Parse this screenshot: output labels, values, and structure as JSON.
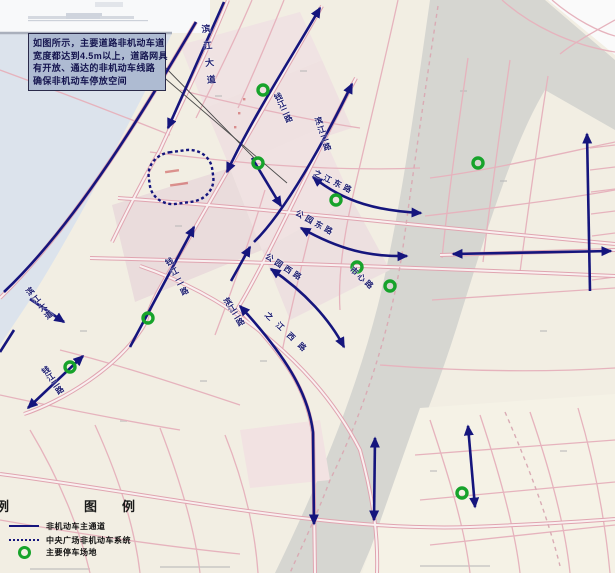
{
  "annotation_box": {
    "l1": "如图所示，主要道路非机动车道",
    "l2": "宽度都达到4.5m以上，道路网具",
    "l3": "有开放、通达的非机动车线路",
    "l4": "确保非机动车停放空间"
  },
  "legend": {
    "partial_title": "例",
    "title": "图　例",
    "items": [
      {
        "symbol": "solid-line",
        "label": "非机动车主通道"
      },
      {
        "symbol": "dashed-line",
        "label": "中央广场非机动车系统"
      },
      {
        "symbol": "green-circle",
        "label": "主要停车场地"
      }
    ]
  },
  "map": {
    "road_labels": [
      {
        "text": "滨江大道",
        "x": 199,
        "y": 24,
        "rot": -6,
        "fs": 9,
        "ls": 8,
        "mode": "v"
      },
      {
        "text": "钱江二路",
        "x": 271,
        "y": 93,
        "rot": -25,
        "fs": 8,
        "ls": 0,
        "mode": "v"
      },
      {
        "text": "滨江二路",
        "x": 312,
        "y": 117,
        "rot": -18,
        "fs": 8,
        "ls": 1,
        "mode": "v"
      },
      {
        "text": "之江东路",
        "x": 314,
        "y": 167,
        "rot": 26,
        "fs": 8,
        "ls": 3,
        "mode": "h"
      },
      {
        "text": "公园东路",
        "x": 296,
        "y": 207,
        "rot": 29,
        "fs": 8,
        "ls": 3,
        "mode": "h"
      },
      {
        "text": "公园西路",
        "x": 266,
        "y": 250,
        "rot": 33,
        "fs": 8,
        "ls": 3,
        "mode": "h"
      },
      {
        "text": "市心路",
        "x": 351,
        "y": 263,
        "rot": 42,
        "fs": 8,
        "ls": 2,
        "mode": "h"
      },
      {
        "text": "之江西路",
        "x": 266,
        "y": 308,
        "rot": 43,
        "fs": 8,
        "ls": 7,
        "mode": "h"
      },
      {
        "text": "钱江二路",
        "x": 162,
        "y": 258,
        "rot": -27,
        "fs": 8,
        "ls": 3,
        "mode": "v"
      },
      {
        "text": "滨江二路",
        "x": 220,
        "y": 298,
        "rot": -32,
        "fs": 8,
        "ls": 0,
        "mode": "v"
      },
      {
        "text": "钱江二路",
        "x": 38,
        "y": 367,
        "rot": -35,
        "fs": 8,
        "ls": 0,
        "mode": "v"
      },
      {
        "text": "滨江大道",
        "x": 22,
        "y": 288,
        "rot": -38,
        "fs": 8,
        "ls": 2,
        "mode": "v"
      }
    ],
    "parking_markers": [
      [
        263,
        90
      ],
      [
        478,
        163
      ],
      [
        258,
        163
      ],
      [
        336,
        200
      ],
      [
        357,
        267
      ],
      [
        390,
        286
      ],
      [
        148,
        318
      ],
      [
        70,
        367
      ],
      [
        462,
        493
      ]
    ],
    "routes": [
      {
        "d": "M224,2 L168,128",
        "s": false,
        "e": true
      },
      {
        "d": "M196,22 C150,100 80,220 4,292",
        "s": false,
        "e": false
      },
      {
        "d": "M30,299 L64,322",
        "s": false,
        "e": true
      },
      {
        "d": "M14,330 L0,352",
        "s": false,
        "e": false
      },
      {
        "d": "M320,8 C290,60 252,118 227,172",
        "s": true,
        "e": true
      },
      {
        "d": "M252,158 L281,206",
        "s": false,
        "e": true
      },
      {
        "d": "M313,177 C345,203 380,211 421,213",
        "s": true,
        "e": true
      },
      {
        "d": "M301,228 C340,250 370,257 407,256",
        "s": true,
        "e": true
      },
      {
        "d": "M231,281 L250,247",
        "s": false,
        "e": true
      },
      {
        "d": "M271,269 C305,292 330,320 344,347",
        "s": true,
        "e": true
      },
      {
        "d": "M352,84 C325,140 285,212 254,242",
        "s": true,
        "e": false
      },
      {
        "d": "M240,306 C285,355 308,392 313,432 L314,524",
        "s": true,
        "e": true
      },
      {
        "d": "M130,347 L194,227",
        "s": false,
        "e": true
      },
      {
        "d": "M28,408 L83,356",
        "s": true,
        "e": true
      },
      {
        "d": "M590,291 L587,134",
        "s": false,
        "e": true
      },
      {
        "d": "M453,254 L611,251",
        "s": true,
        "e": true
      },
      {
        "d": "M468,426 L475,507",
        "s": true,
        "e": true
      },
      {
        "d": "M375,438 L374,520",
        "s": true,
        "e": true
      }
    ],
    "leader_lines": [
      "M160,62 L256,160",
      "M160,74 L287,183"
    ],
    "central_loop": {
      "cx": 181,
      "cy": 177,
      "w": 64,
      "h": 52,
      "rot": -8
    }
  },
  "colors": {
    "route": "#15157d",
    "parking": "#17a32b",
    "road_pink": "#e2a6b2",
    "water": "#dce3ec",
    "land": "#f2eee3",
    "gray_corridor": "#d6d6d1",
    "annotation_bg": "#aebbd2",
    "label_text": "#1c1c6e"
  }
}
